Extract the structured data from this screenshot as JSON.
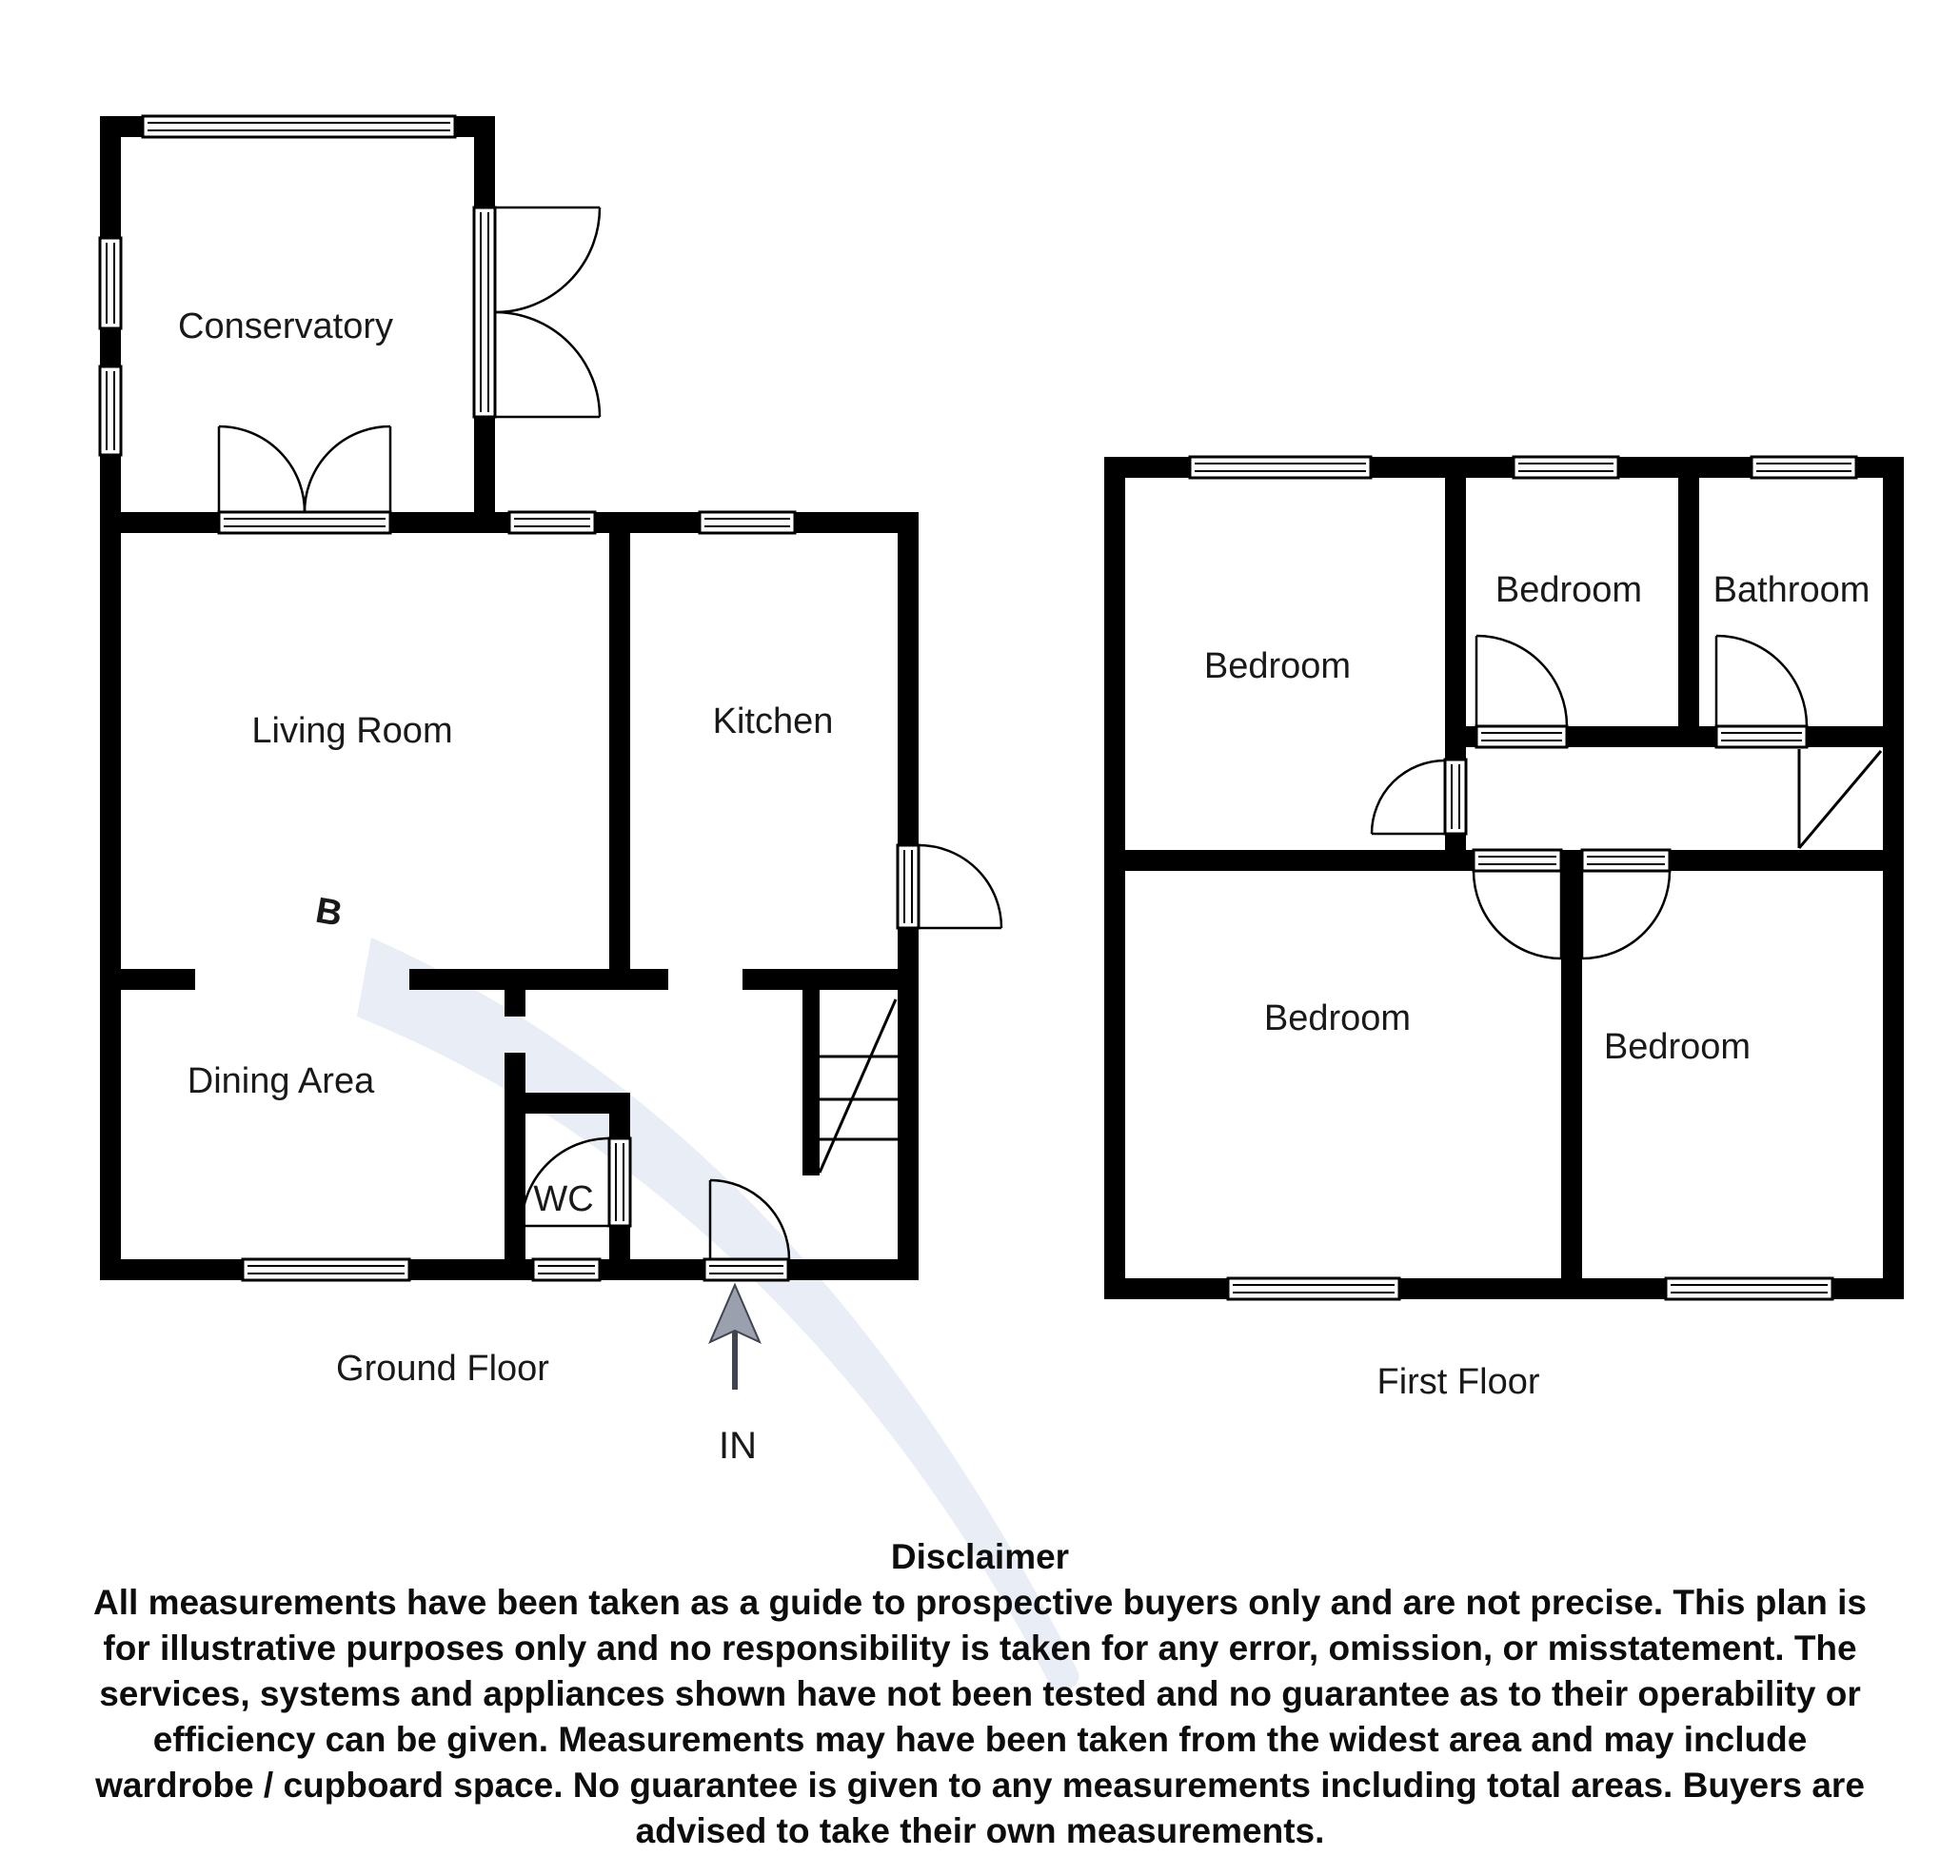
{
  "watermark": {
    "letter": "B",
    "color": "#e9edf6"
  },
  "ground_floor": {
    "name": "Ground Floor",
    "entrance_label": "IN",
    "rooms": [
      {
        "label": "Conservatory"
      },
      {
        "label": "Living Room"
      },
      {
        "label": "Kitchen"
      },
      {
        "label": "Dining Area"
      },
      {
        "label": "WC"
      }
    ]
  },
  "first_floor": {
    "name": "First Floor",
    "rooms": [
      {
        "label": "Bedroom"
      },
      {
        "label": "Bedroom"
      },
      {
        "label": "Bathroom"
      },
      {
        "label": "Bedroom"
      },
      {
        "label": "Bedroom"
      }
    ]
  },
  "disclaimer": {
    "title": "Disclaimer",
    "lines": [
      "All measurements have been taken as a guide to prospective buyers only and are not precise. This plan is",
      "for illustrative purposes only and no responsibility is taken for any error, omission, or misstatement. The",
      "services, systems and appliances shown have not been tested and no guarantee as to their operability or",
      "efficiency can be given. Measurements may have been taken from the widest area and may include",
      "wardrobe / cupboard space. No guarantee is given to any measurements including total areas. Buyers are",
      "advised to take their own measurements."
    ]
  },
  "colors": {
    "wall": "#000000",
    "watermark": "#e9edf6",
    "arrow": "#9aa0ad"
  }
}
